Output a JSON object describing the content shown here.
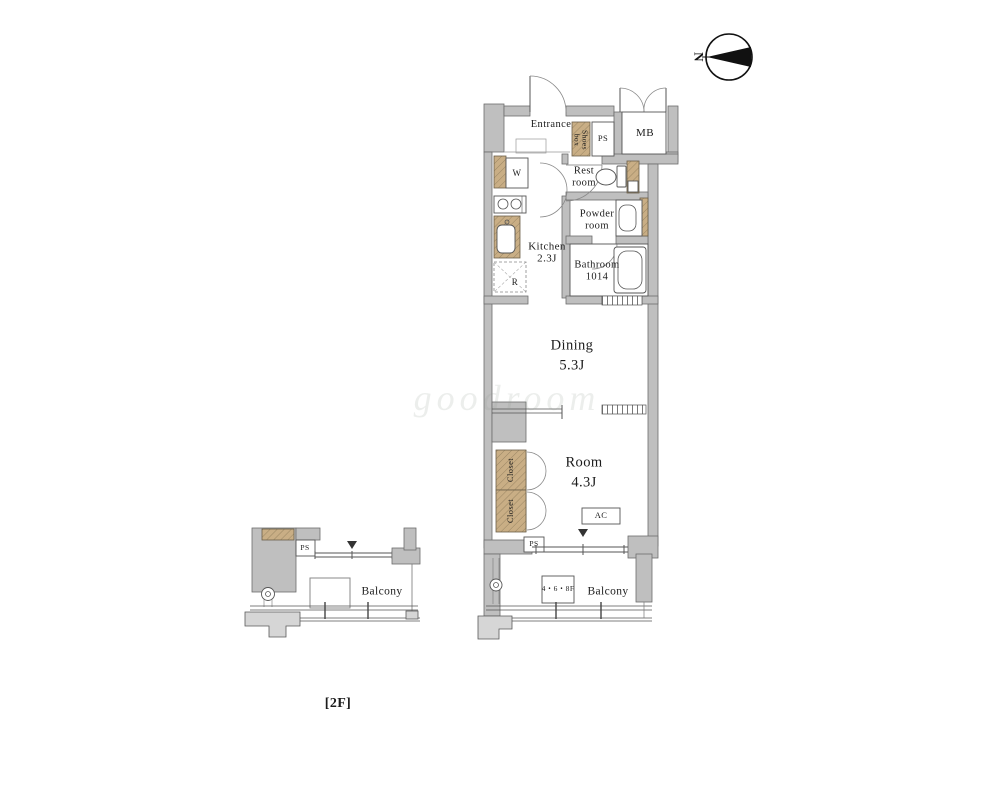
{
  "watermark_text": "goodroom",
  "floor_note": "[2F]",
  "compass": {
    "north": "N"
  },
  "unit": {
    "entrance": "Entrance",
    "shoes_box": [
      "Shoes",
      "box"
    ],
    "pipe_space_entry": "PS",
    "meter_box": "MB",
    "washer": "W",
    "rest_room": [
      "Rest",
      "room"
    ],
    "powder_room": [
      "Powder",
      "room"
    ],
    "bathroom": [
      "Bathroom",
      "1014"
    ],
    "kitchen": [
      "Kitchen",
      "2.3J"
    ],
    "refrigerator": "R",
    "dining": [
      "Dining",
      "5.3J"
    ],
    "main_room": [
      "Room",
      "4.3J"
    ],
    "closet_upper": "Closet",
    "closet_lower": "Closet",
    "air_conditioner": "AC",
    "pipe_space_room": "PS",
    "balcony": "Balcony",
    "balcony_floor_note": "4・6・8F"
  },
  "left_wing": {
    "pipe_space": "PS",
    "balcony": "Balcony"
  },
  "colors": {
    "wall": "#bfbfbf",
    "cabinet": "#c9ae85",
    "line": "#555555",
    "slab": "#d6d6d6",
    "marker": "#333333",
    "compass_arrow": "#111111"
  }
}
